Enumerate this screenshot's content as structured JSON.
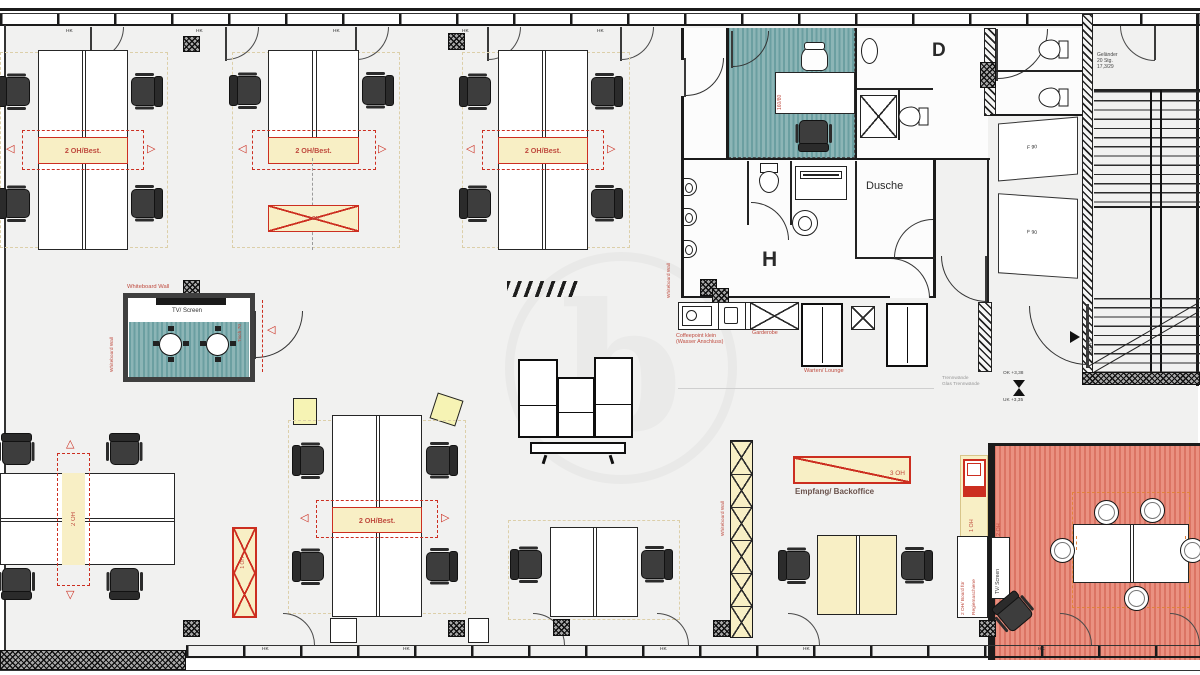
{
  "palette": {
    "red1": "#bf4a3e",
    "red2": "#cc2e20",
    "yellow": "#f8efc5",
    "orange": "#e2833c",
    "teal": "#74a5a7",
    "salmon": "#e07b6b",
    "wall": "#1b1b1b",
    "floor": "#f1f1f0"
  },
  "labels": {
    "hk": "HK",
    "whiteboard_wall": "Whiteboard Wall",
    "tv_screen": "TV/ Screen",
    "best": "2 OH/Best.",
    "oh1": "1 OH",
    "oh2": "2 OH",
    "oh3": "3 OH",
    "board_l1": "2 OH/ Board für",
    "board_l2": "Regiemaschiene",
    "empfang": "Empfang/ Backoffice",
    "coffee_l1": "Coffeepoint klein",
    "coffee_l2": "(Wasser Anschluss)",
    "garderobe": "Garderobe",
    "lounge": "Warten/ Lounge",
    "dusche": "Dusche",
    "wc_men": "H",
    "wc_women": "D",
    "desk_size": "160/80",
    "tisch": "Tisch 70",
    "stair_l1": "Geländer",
    "stair_l2": "20 Stg.",
    "stair_l3": "17,3/29",
    "fire_door": "T30 RS",
    "f90": "F 90",
    "level_top": "OK +3,38",
    "level_bottom": "UK +3,35",
    "note_l1": "Trennwände",
    "note_l2": "Glas Trennwände",
    "watermark": "b"
  }
}
